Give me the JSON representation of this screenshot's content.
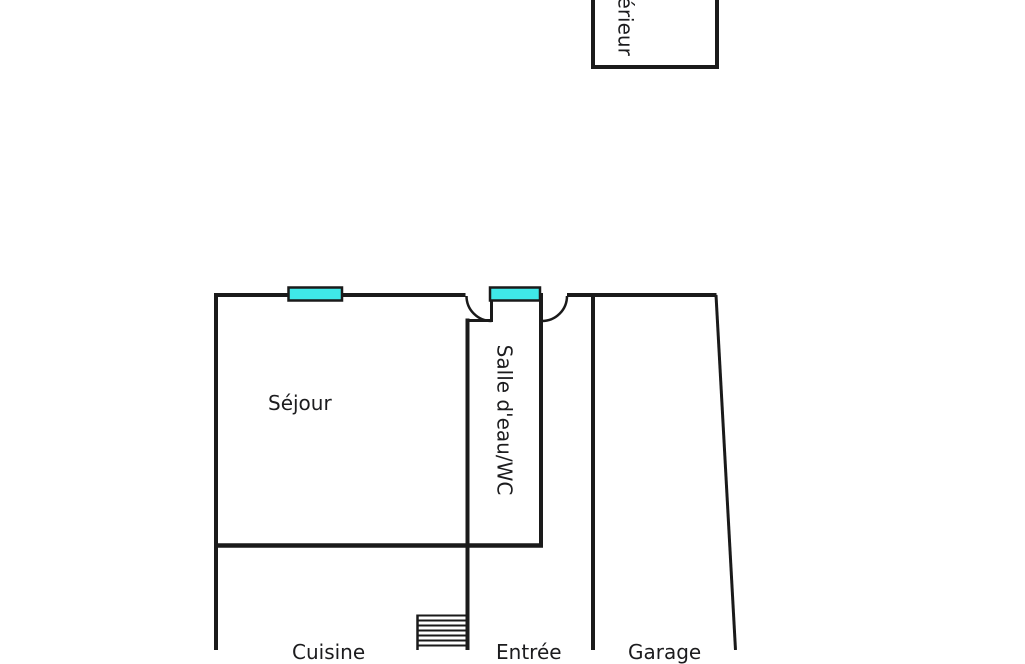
{
  "plan": {
    "type": "floor-plan",
    "colors": {
      "wall": "#1a1a1a",
      "window_fill": "#3fe9e9",
      "label": "#1c1c1e"
    },
    "rooms": {
      "sejour": {
        "label": "Séjour"
      },
      "salle_eau": {
        "label": "Salle d'eau/WC"
      },
      "exterieur": {
        "label": "Extérieur"
      },
      "cuisine": {
        "label": "Cuisine"
      },
      "entree": {
        "label": "Entrée"
      },
      "garage": {
        "label": "Garage"
      }
    }
  }
}
